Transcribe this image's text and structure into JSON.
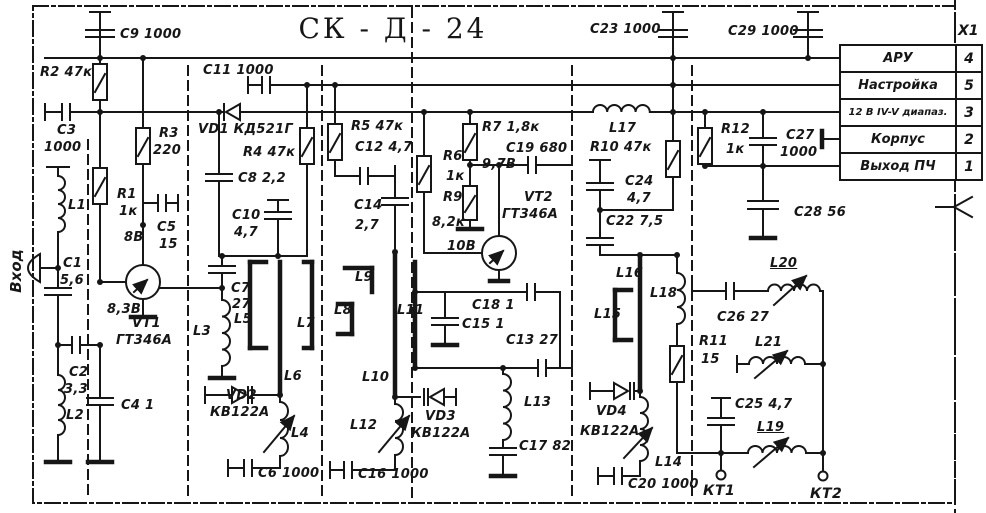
{
  "title": "СК - Д - 24",
  "input_label": "Вход",
  "connector": {
    "name": "X1",
    "rows": [
      {
        "label": "АРУ",
        "pin": "4"
      },
      {
        "label": "Настройка",
        "pin": "5"
      },
      {
        "label": "12 В IV-V диапаз.",
        "pin": "3"
      },
      {
        "label": "Корпус",
        "pin": "2"
      },
      {
        "label": "Выход ПЧ",
        "pin": "1"
      }
    ]
  },
  "test_points": [
    {
      "label": "КТ1"
    },
    {
      "label": "КТ2"
    }
  ],
  "colors": {
    "ink": "#161616",
    "paper": "#ffffff"
  },
  "labels": [
    {
      "n": "c9",
      "t": "C9 1000",
      "x": 120,
      "y": 28
    },
    {
      "n": "r2",
      "t": "R2 47к",
      "x": 40,
      "y": 66
    },
    {
      "n": "c3-ref",
      "t": "C3",
      "x": 57,
      "y": 124
    },
    {
      "n": "c3-val",
      "t": "1000",
      "x": 44,
      "y": 141
    },
    {
      "n": "r3-ref",
      "t": "R3",
      "x": 159,
      "y": 127
    },
    {
      "n": "r3-val",
      "t": "220",
      "x": 153,
      "y": 144
    },
    {
      "n": "r1-ref",
      "t": "R1",
      "x": 117,
      "y": 188
    },
    {
      "n": "r1-val",
      "t": "1к",
      "x": 119,
      "y": 205
    },
    {
      "n": "c5-ref",
      "t": "C5",
      "x": 157,
      "y": 221
    },
    {
      "n": "c5-val",
      "t": "15",
      "x": 159,
      "y": 238
    },
    {
      "n": "v8",
      "t": "8В",
      "x": 124,
      "y": 231
    },
    {
      "n": "v83",
      "t": "8,3В",
      "x": 107,
      "y": 303
    },
    {
      "n": "vt1-ref",
      "t": "VT1",
      "x": 132,
      "y": 317
    },
    {
      "n": "vt1-type",
      "t": "ГТ346А",
      "x": 116,
      "y": 334
    },
    {
      "n": "c1-ref",
      "t": "C1",
      "x": 63,
      "y": 257
    },
    {
      "n": "c1-val",
      "t": "5,6",
      "x": 60,
      "y": 274
    },
    {
      "n": "l1",
      "t": "L1",
      "x": 68,
      "y": 199
    },
    {
      "n": "c2-ref",
      "t": "C2",
      "x": 69,
      "y": 366
    },
    {
      "n": "c2-val",
      "t": "3,3",
      "x": 64,
      "y": 383
    },
    {
      "n": "l2",
      "t": "L2",
      "x": 66,
      "y": 409
    },
    {
      "n": "c4",
      "t": "C4 1",
      "x": 121,
      "y": 399
    },
    {
      "n": "c11",
      "t": "C11 1000",
      "x": 203,
      "y": 64
    },
    {
      "n": "vd1",
      "t": "VD1 КД521Г",
      "x": 198,
      "y": 123
    },
    {
      "n": "r4",
      "t": "R4 47к",
      "x": 243,
      "y": 146
    },
    {
      "n": "c8",
      "t": "C8 2,2",
      "x": 238,
      "y": 172
    },
    {
      "n": "c10-ref",
      "t": "C10",
      "x": 232,
      "y": 209
    },
    {
      "n": "c10-val",
      "t": "4,7",
      "x": 234,
      "y": 226
    },
    {
      "n": "c7-ref",
      "t": "C7",
      "x": 231,
      "y": 282
    },
    {
      "n": "c7-val",
      "t": "27",
      "x": 232,
      "y": 298
    },
    {
      "n": "l3",
      "t": "L3",
      "x": 193,
      "y": 325
    },
    {
      "n": "l5",
      "t": "L5",
      "x": 234,
      "y": 313
    },
    {
      "n": "l6",
      "t": "L6",
      "x": 284,
      "y": 370
    },
    {
      "n": "l7",
      "t": "L7",
      "x": 297,
      "y": 317
    },
    {
      "n": "vd2-ref",
      "t": "VD2",
      "x": 226,
      "y": 389
    },
    {
      "n": "vd2-type",
      "t": "КВ122А",
      "x": 210,
      "y": 406
    },
    {
      "n": "l4",
      "t": "L4",
      "x": 291,
      "y": 427
    },
    {
      "n": "c6",
      "t": "C6 1000",
      "x": 258,
      "y": 467
    },
    {
      "n": "r5",
      "t": "R5 47к",
      "x": 351,
      "y": 120
    },
    {
      "n": "c12",
      "t": "C12 4,7",
      "x": 355,
      "y": 141
    },
    {
      "n": "c14-ref",
      "t": "C14",
      "x": 354,
      "y": 199
    },
    {
      "n": "c14-val",
      "t": "2,7",
      "x": 355,
      "y": 219
    },
    {
      "n": "l9",
      "t": "L9",
      "x": 355,
      "y": 271
    },
    {
      "n": "l8",
      "t": "L8",
      "x": 334,
      "y": 304
    },
    {
      "n": "l10",
      "t": "L10",
      "x": 362,
      "y": 371
    },
    {
      "n": "l12",
      "t": "L12",
      "x": 350,
      "y": 419
    },
    {
      "n": "c16",
      "t": "C16 1000",
      "x": 358,
      "y": 468
    },
    {
      "n": "r6-ref",
      "t": "R6",
      "x": 443,
      "y": 150
    },
    {
      "n": "r6-val",
      "t": "1к",
      "x": 446,
      "y": 170
    },
    {
      "n": "r9-ref",
      "t": "R9",
      "x": 443,
      "y": 191
    },
    {
      "n": "r9-val",
      "t": "8,2к",
      "x": 432,
      "y": 216
    },
    {
      "n": "r7",
      "t": "R7 1,8к",
      "x": 482,
      "y": 121
    },
    {
      "n": "c19",
      "t": "C19 680",
      "x": 506,
      "y": 142
    },
    {
      "n": "v97",
      "t": "9,7В",
      "x": 482,
      "y": 158
    },
    {
      "n": "vt2-ref",
      "t": "VT2",
      "x": 524,
      "y": 191
    },
    {
      "n": "vt2-type",
      "t": "ГТ346А",
      "x": 502,
      "y": 208
    },
    {
      "n": "v10",
      "t": "10В",
      "x": 447,
      "y": 240
    },
    {
      "n": "l11",
      "t": "L11",
      "x": 397,
      "y": 304
    },
    {
      "n": "c18",
      "t": "C18 1",
      "x": 472,
      "y": 299
    },
    {
      "n": "c15",
      "t": "C15 1",
      "x": 462,
      "y": 318
    },
    {
      "n": "c13",
      "t": "C13 27",
      "x": 506,
      "y": 334
    },
    {
      "n": "vd3-ref",
      "t": "VD3",
      "x": 425,
      "y": 410
    },
    {
      "n": "vd3-type",
      "t": "КВ122А",
      "x": 411,
      "y": 427
    },
    {
      "n": "l13",
      "t": "L13",
      "x": 524,
      "y": 396
    },
    {
      "n": "c17",
      "t": "C17 82",
      "x": 519,
      "y": 440
    },
    {
      "n": "c23",
      "t": "C23 1000",
      "x": 590,
      "y": 23
    },
    {
      "n": "c29",
      "t": "C29 1000",
      "x": 728,
      "y": 25
    },
    {
      "n": "l17",
      "t": "L17",
      "x": 609,
      "y": 122
    },
    {
      "n": "r10",
      "t": "R10 47к",
      "x": 590,
      "y": 141
    },
    {
      "n": "c24-ref",
      "t": "C24",
      "x": 625,
      "y": 175
    },
    {
      "n": "c24-val",
      "t": "4,7",
      "x": 627,
      "y": 192
    },
    {
      "n": "c22",
      "t": "C22 7,5",
      "x": 606,
      "y": 215
    },
    {
      "n": "l16",
      "t": "L16",
      "x": 616,
      "y": 267
    },
    {
      "n": "l15",
      "t": "L15",
      "x": 594,
      "y": 308
    },
    {
      "n": "l18",
      "t": "L18",
      "x": 650,
      "y": 287
    },
    {
      "n": "vd4-ref",
      "t": "VD4",
      "x": 596,
      "y": 405
    },
    {
      "n": "vd4-type",
      "t": "КВ122А",
      "x": 580,
      "y": 425
    },
    {
      "n": "l14",
      "t": "L14",
      "x": 655,
      "y": 456
    },
    {
      "n": "c20",
      "t": "C20 1000",
      "x": 628,
      "y": 478
    },
    {
      "n": "r12-ref",
      "t": "R12",
      "x": 721,
      "y": 123
    },
    {
      "n": "r12-val",
      "t": "1к",
      "x": 726,
      "y": 143
    },
    {
      "n": "c27-ref",
      "t": "C27",
      "x": 786,
      "y": 129
    },
    {
      "n": "c27-val",
      "t": "1000",
      "x": 780,
      "y": 146
    },
    {
      "n": "c28",
      "t": "C28 56",
      "x": 794,
      "y": 206
    },
    {
      "n": "c26",
      "t": "C26 27",
      "x": 717,
      "y": 311
    },
    {
      "n": "r11-ref",
      "t": "R11",
      "x": 699,
      "y": 335
    },
    {
      "n": "r11-val",
      "t": "15",
      "x": 701,
      "y": 353
    },
    {
      "n": "l21",
      "t": "L21",
      "x": 755,
      "y": 336
    },
    {
      "n": "l20",
      "t": "L20",
      "x": 770,
      "y": 257,
      "u": 1
    },
    {
      "n": "c25",
      "t": "C25 4,7",
      "x": 735,
      "y": 398
    },
    {
      "n": "l19",
      "t": "L19",
      "x": 757,
      "y": 421,
      "u": 1
    }
  ]
}
